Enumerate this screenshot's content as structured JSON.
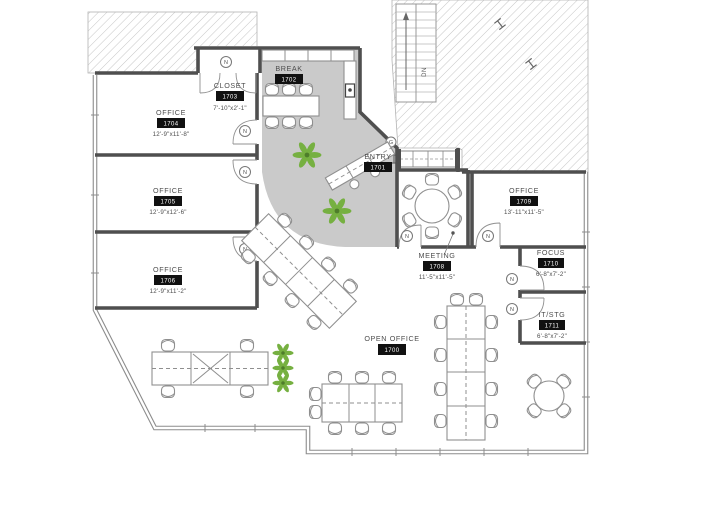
{
  "document": {
    "type": "architectural-floor-plan"
  },
  "rooms": {
    "closet": {
      "name": "CLOSET",
      "number": "1703",
      "dims": "7'-10\"x2'-1\""
    },
    "break_room": {
      "name": "BREAK",
      "number": "1702"
    },
    "entry": {
      "name": "ENTRY",
      "number": "1701"
    },
    "office_a": {
      "name": "OFFICE",
      "number": "1704",
      "dims": "12'-9\"x11'-8\""
    },
    "office_b": {
      "name": "OFFICE",
      "number": "1705",
      "dims": "12'-9\"x12'-6\""
    },
    "office_c": {
      "name": "OFFICE",
      "number": "1706",
      "dims": "12'-9\"x11'-2\""
    },
    "meeting": {
      "name": "MEETING",
      "number": "1708",
      "dims": "11'-5\"x11'-5\""
    },
    "office_d": {
      "name": "OFFICE",
      "number": "1709",
      "dims": "13'-11\"x11'-5\""
    },
    "focus": {
      "name": "FOCUS",
      "number": "1710",
      "dims": "6'-8\"x7'-2\""
    },
    "it_stg": {
      "name": "IT/STG",
      "number": "1711",
      "dims": "6'-8\"x7'-2\""
    },
    "open_office": {
      "name": "OPEN OFFICE",
      "number": "1700"
    }
  },
  "annotations": {
    "stair_direction": "DN",
    "door_tag": "N",
    "entry_door_tag": "G"
  },
  "colors": {
    "lounge_floor": "#cacaca",
    "wall": "#4f4f4f",
    "furniture_line": "#8f8f8f",
    "plant_green": "#76b041",
    "badge_bg": "#111111",
    "badge_text": "#ffffff"
  }
}
